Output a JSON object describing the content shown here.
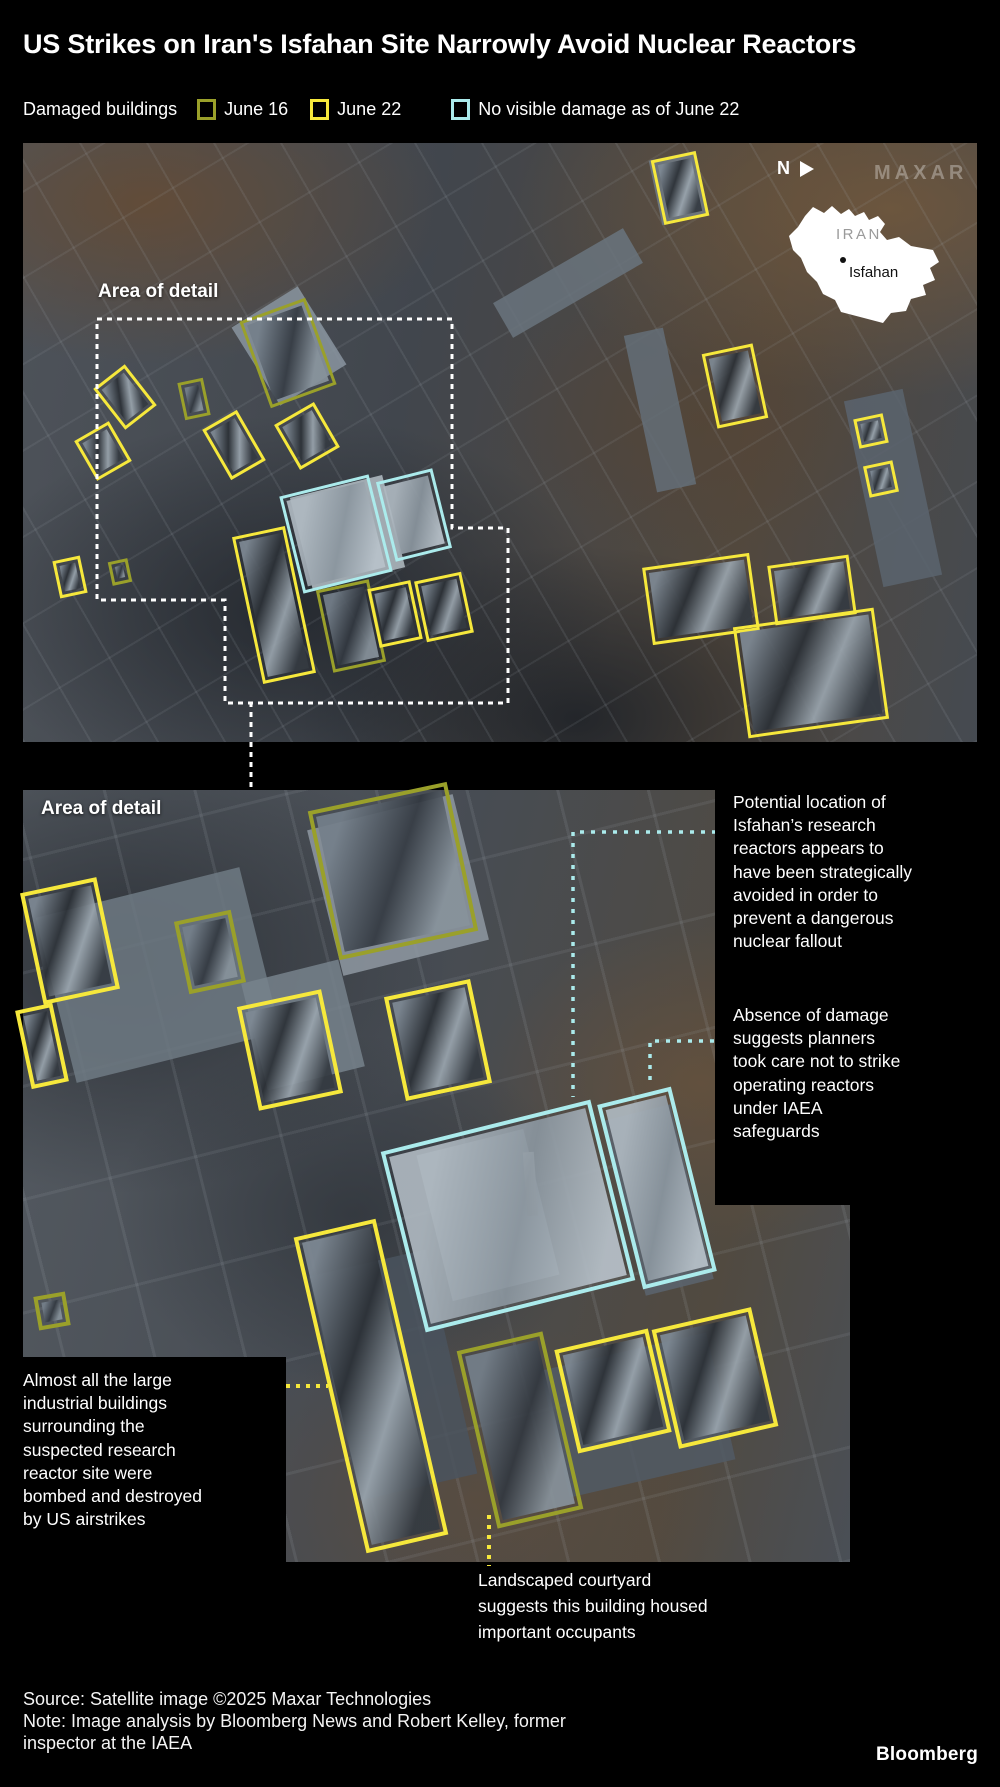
{
  "title": "US Strikes on Iran's Isfahan Site Narrowly Avoid Nuclear Reactors",
  "legend": {
    "label": "Damaged buildings",
    "items": [
      {
        "label": "June 16",
        "key": "june16",
        "color": "#9aa02a"
      },
      {
        "label": "June 22",
        "key": "june22",
        "color": "#f6e83c"
      },
      {
        "label": "No visible damage as of June 22",
        "key": "nodamage",
        "color": "#abebec"
      }
    ]
  },
  "colors": {
    "june16": "#9aa02a",
    "june22": "#f6e83c",
    "nodamage": "#abebec",
    "white": "#ffffff",
    "background": "#000000"
  },
  "overview": {
    "area_label": "Area of detail",
    "compass": "N",
    "watermark": "MAXAR"
  },
  "inset": {
    "country": "IRAN",
    "city": "Isfahan"
  },
  "detail": {
    "area_label": "Area of detail"
  },
  "annotations": {
    "potential_location": "Potential location of\nIsfahan’s research\nreactors appears to\nhave been strategically\navoided in order to\nprevent a dangerous\nnuclear fallout",
    "absence_of_damage": "Absence of damage\nsuggests planners\ntook care not to strike\noperating reactors\nunder IAEA\nsafeguards",
    "almost_all": "Almost all the large\nindustrial buildings\nsurrounding the\nsuspected research\nreactor site were\nbombed and destroyed\nby US airstrikes",
    "landscaped": "Landscaped courtyard\nsuggests this building housed\nimportant occupants"
  },
  "footer": {
    "source": "Source: Satellite image ©2025 Maxar Technologies",
    "note": "Note: Image analysis by Bloomberg News and Robert Kelley, former\ninspector at the IAEA",
    "logo": "Bloomberg"
  },
  "boxes": [
    {
      "type": "june22",
      "cx": 680,
      "cy": 188,
      "w": 46,
      "h": 66,
      "r": -12
    },
    {
      "type": "june22",
      "cx": 735,
      "cy": 386,
      "w": 52,
      "h": 76,
      "r": -12
    },
    {
      "type": "june22",
      "cx": 871,
      "cy": 431,
      "w": 30,
      "h": 30,
      "r": -12
    },
    {
      "type": "june22",
      "cx": 881,
      "cy": 479,
      "w": 30,
      "h": 32,
      "r": -12
    },
    {
      "type": "june16",
      "cx": 288,
      "cy": 353,
      "w": 70,
      "h": 92,
      "r": -20
    },
    {
      "type": "june22",
      "cx": 125,
      "cy": 397,
      "w": 40,
      "h": 52,
      "r": -38
    },
    {
      "type": "june16",
      "cx": 194,
      "cy": 399,
      "w": 26,
      "h": 38,
      "r": -12
    },
    {
      "type": "june22",
      "cx": 234,
      "cy": 445,
      "w": 40,
      "h": 58,
      "r": -30
    },
    {
      "type": "june22",
      "cx": 307,
      "cy": 436,
      "w": 46,
      "h": 52,
      "r": -30
    },
    {
      "type": "june22",
      "cx": 103,
      "cy": 451,
      "w": 40,
      "h": 46,
      "r": -30
    },
    {
      "type": "nodamage",
      "cx": 336,
      "cy": 534,
      "w": 92,
      "h": 100,
      "r": -14
    },
    {
      "type": "nodamage",
      "cx": 414,
      "cy": 515,
      "w": 58,
      "h": 82,
      "r": -14
    },
    {
      "type": "june22",
      "cx": 274,
      "cy": 605,
      "w": 54,
      "h": 150,
      "r": -12
    },
    {
      "type": "june16",
      "cx": 351,
      "cy": 626,
      "w": 54,
      "h": 84,
      "r": -12
    },
    {
      "type": "june22",
      "cx": 395,
      "cy": 614,
      "w": 44,
      "h": 60,
      "r": -12
    },
    {
      "type": "june22",
      "cx": 444,
      "cy": 607,
      "w": 48,
      "h": 62,
      "r": -12
    },
    {
      "type": "june22",
      "cx": 70,
      "cy": 577,
      "w": 28,
      "h": 38,
      "r": -12
    },
    {
      "type": "june16",
      "cx": 120,
      "cy": 572,
      "w": 20,
      "h": 24,
      "r": -12
    },
    {
      "type": "june22",
      "cx": 701,
      "cy": 599,
      "w": 108,
      "h": 78,
      "r": -8
    },
    {
      "type": "june22",
      "cx": 812,
      "cy": 590,
      "w": 82,
      "h": 60,
      "r": -8
    },
    {
      "type": "june22",
      "cx": 811,
      "cy": 673,
      "w": 142,
      "h": 112,
      "r": -8
    },
    {
      "type": "june22",
      "cx": 70,
      "cy": 941,
      "w": 78,
      "h": 114,
      "r": -12
    },
    {
      "type": "june22",
      "cx": 42,
      "cy": 1046,
      "w": 38,
      "h": 80,
      "r": -12
    },
    {
      "type": "june16",
      "cx": 210,
      "cy": 952,
      "w": 58,
      "h": 74,
      "r": -12
    },
    {
      "type": "june16",
      "cx": 393,
      "cy": 871,
      "w": 142,
      "h": 152,
      "r": -12
    },
    {
      "type": "june22",
      "cx": 290,
      "cy": 1050,
      "w": 86,
      "h": 106,
      "r": -12
    },
    {
      "type": "june22",
      "cx": 438,
      "cy": 1040,
      "w": 88,
      "h": 106,
      "r": -12
    },
    {
      "type": "nodamage",
      "cx": 508,
      "cy": 1216,
      "w": 216,
      "h": 186,
      "r": -14
    },
    {
      "type": "nodamage",
      "cx": 657,
      "cy": 1188,
      "w": 76,
      "h": 190,
      "r": -14
    },
    {
      "type": "june22",
      "cx": 371,
      "cy": 1386,
      "w": 84,
      "h": 324,
      "r": -13
    },
    {
      "type": "june16",
      "cx": 520,
      "cy": 1430,
      "w": 88,
      "h": 182,
      "r": -13
    },
    {
      "type": "june22",
      "cx": 613,
      "cy": 1391,
      "w": 96,
      "h": 106,
      "r": -13
    },
    {
      "type": "june22",
      "cx": 715,
      "cy": 1378,
      "w": 102,
      "h": 122,
      "r": -13
    },
    {
      "type": "june16",
      "cx": 52,
      "cy": 1311,
      "w": 32,
      "h": 34,
      "r": -10
    }
  ],
  "overlays": [
    {
      "name": "area-of-detail-outline",
      "d": "M97,319 H452 V528 H508 V703 H225 V600 H97 Z",
      "stroke": "white",
      "dash": "5 5",
      "w": 3
    },
    {
      "name": "detail-connector-line",
      "d": "M251,702 V792",
      "stroke": "white",
      "dash": "5 5",
      "w": 3
    },
    {
      "name": "leader-potential-location",
      "d": "M716,832 H573 V1097",
      "stroke": "nodamage",
      "dash": "4 7",
      "w": 3.5
    },
    {
      "name": "leader-absence-of-damage",
      "d": "M714,1041 H650 V1083",
      "stroke": "nodamage",
      "dash": "4 7",
      "w": 3.5
    },
    {
      "name": "leader-almost-all",
      "d": "M286,1386 H328",
      "stroke": "june22",
      "dash": "4 6",
      "w": 4
    },
    {
      "name": "leader-landscaped",
      "d": "M489,1515 V1566",
      "stroke": "june22",
      "dash": "4 6",
      "w": 4
    }
  ]
}
